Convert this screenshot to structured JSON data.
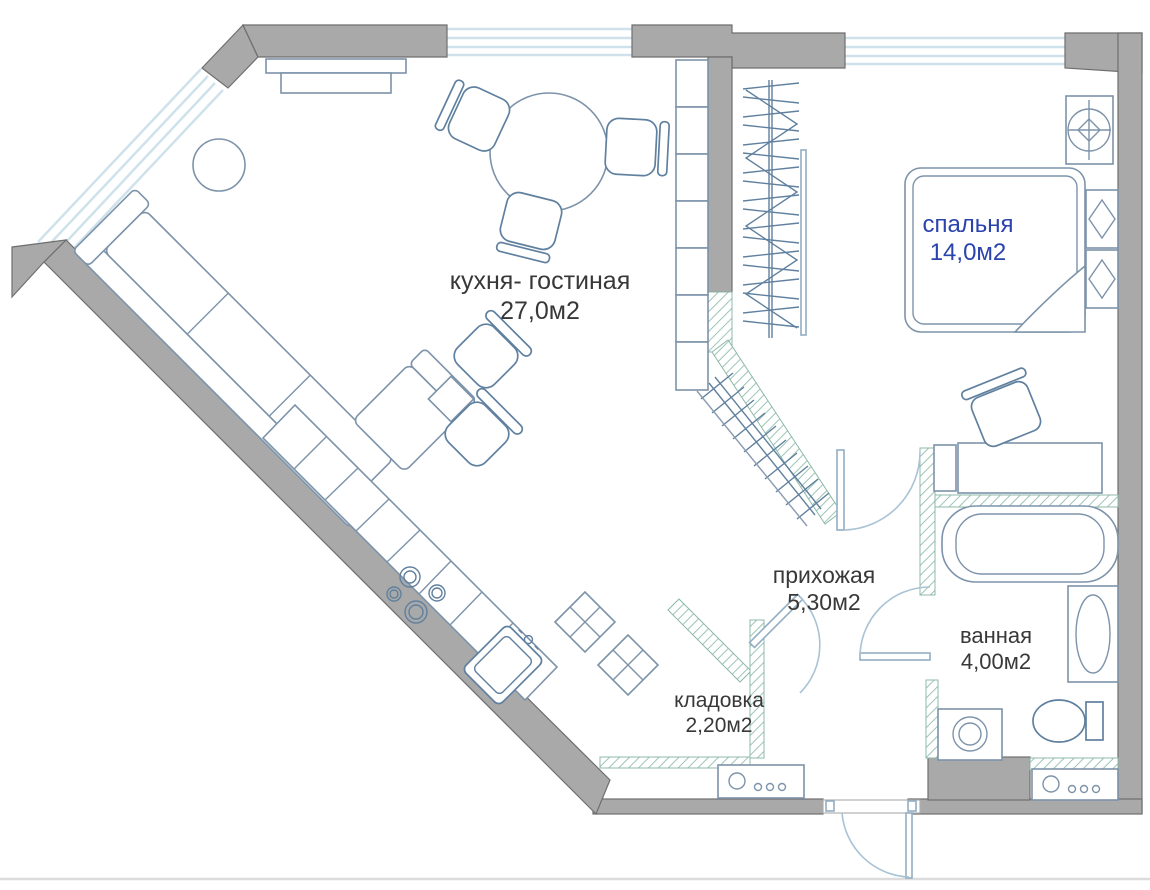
{
  "floor_plan": {
    "title": "apartment-floor-plan",
    "rooms": [
      {
        "id": "kitchen_living",
        "name": "кухня- гостиная",
        "area": "27,0м2"
      },
      {
        "id": "bedroom",
        "name": "спальня",
        "area": "14,0м2"
      },
      {
        "id": "hallway",
        "name": "прихожая",
        "area": "5,30м2"
      },
      {
        "id": "bathroom",
        "name": "ванная",
        "area": "4,00м2"
      },
      {
        "id": "storage",
        "name": "кладовка",
        "area": "2,20м2"
      }
    ],
    "colors": {
      "wall": "#a9a9a9",
      "wall_outline": "#6e6e6e",
      "window_line": "#cfe2ec",
      "partition_hatch": "#8cb8a8",
      "furniture_line": "#7d93aa",
      "furniture_dark_line": "#60809f",
      "door_arc": "#a9c3d4",
      "label_dark": "#383838",
      "label_accent": "#2a43ad",
      "background": "#ffffff"
    },
    "furniture_icons": [
      "corner-sofa",
      "coffee-table",
      "sideboard",
      "dining-table",
      "dining-chair",
      "lounge-chair",
      "side-table",
      "kitchen-counter",
      "stove-burners",
      "kitchen-sink",
      "tall-cabinet-x",
      "wardrobe-shelves",
      "hanging-rail",
      "sliding-door",
      "corner-wardrobe-rail",
      "bed",
      "nightstand",
      "ceiling-light",
      "desk",
      "desk-chair",
      "bathtub",
      "wash-basin",
      "toilet",
      "washing-machine",
      "shoe-cabinet",
      "bathroom-cabinet",
      "ventilation-shaft",
      "entrance-door",
      "bedroom-door",
      "bathroom-door",
      "storage-door",
      "window"
    ]
  }
}
